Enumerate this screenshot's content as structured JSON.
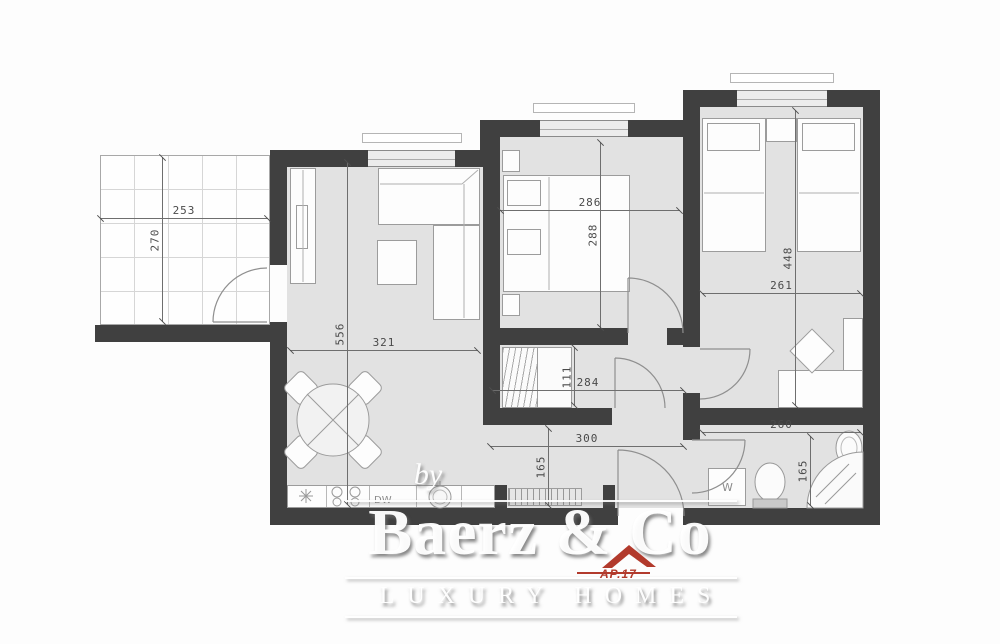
{
  "watermark": {
    "prefix": "by",
    "brand": "Baerz & Co",
    "tagline": "LUXURY HOMES",
    "unit_code": "AP.17"
  },
  "appliances": {
    "dishwasher": "DW",
    "washing_machine": "W"
  },
  "dimensions": {
    "terrace_width": "253",
    "terrace_depth": "270",
    "living_depth": "556",
    "living_width": "321",
    "bedroom1_width": "286",
    "bedroom1_depth": "288",
    "bedroom2_depth": "448",
    "bedroom2_width": "261",
    "closet_depth": "111",
    "hallway_width": "284",
    "hallway_length": "300",
    "hallway_depth": "165",
    "bathroom_width": "260",
    "bathroom_depth": "165"
  },
  "colors": {
    "wall": "#404040",
    "floor": "#e2e2e2",
    "accent_red": "#b23a2c",
    "dimension_text": "#4a4a4a"
  }
}
